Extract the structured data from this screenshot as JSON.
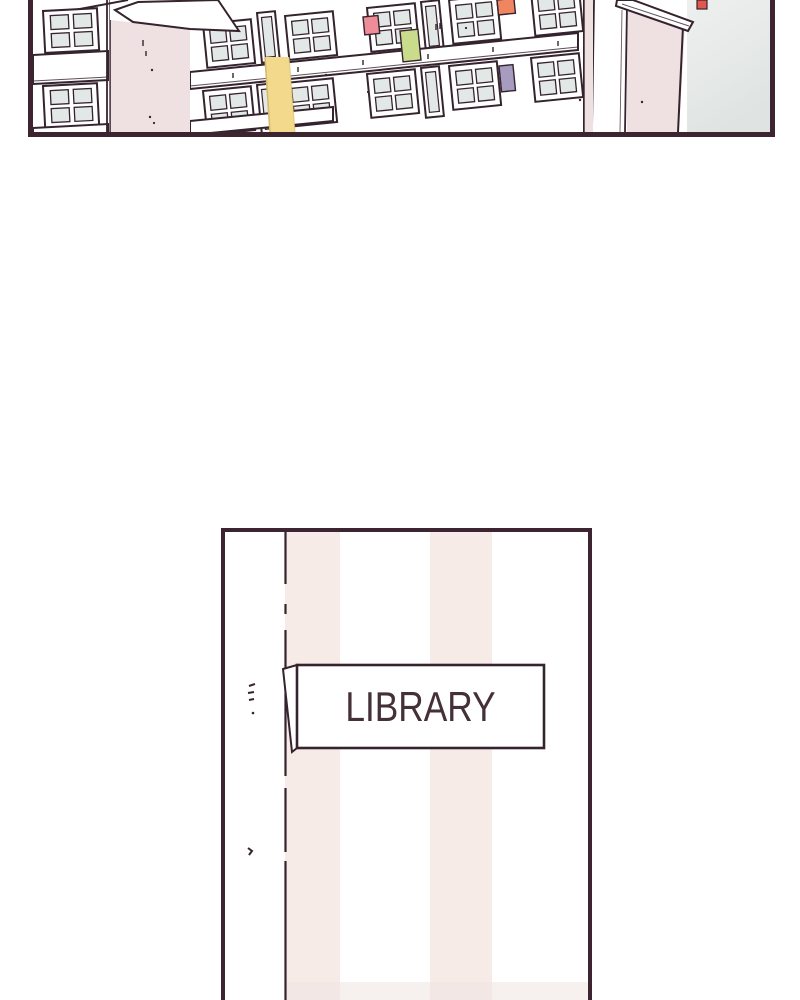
{
  "scene": {
    "type": "webtoon-strip",
    "panel_top_description": "exterior of a school building, cropped close-up",
    "panel_bottom_description": "library door with vertical striped pattern and name plate"
  },
  "library_sign": {
    "label": "LIBRARY"
  },
  "colors": {
    "page_bg": "#ffffff",
    "panel_border": "#3c2531",
    "line": "#35232e",
    "building_white": "#ffffff",
    "wall_pink": "#efe1e2",
    "pane_grey": "#e2e8e6",
    "sky_top": "#eef0ef",
    "sky_bottom": "#dfe4e2",
    "banner_yellow": "#f2d98c",
    "banner_edge": "#d8ba6e",
    "accent_red": "#ee8d98",
    "accent_green": "#c9dc8c",
    "accent_orange": "#f08562",
    "accent_purple": "#a79bc0",
    "accent_red_small": "#e2574d",
    "stripe_pink": "#f7ebe8",
    "door_bottom_shade": "#efe3e0",
    "sign_text": "#453039"
  }
}
